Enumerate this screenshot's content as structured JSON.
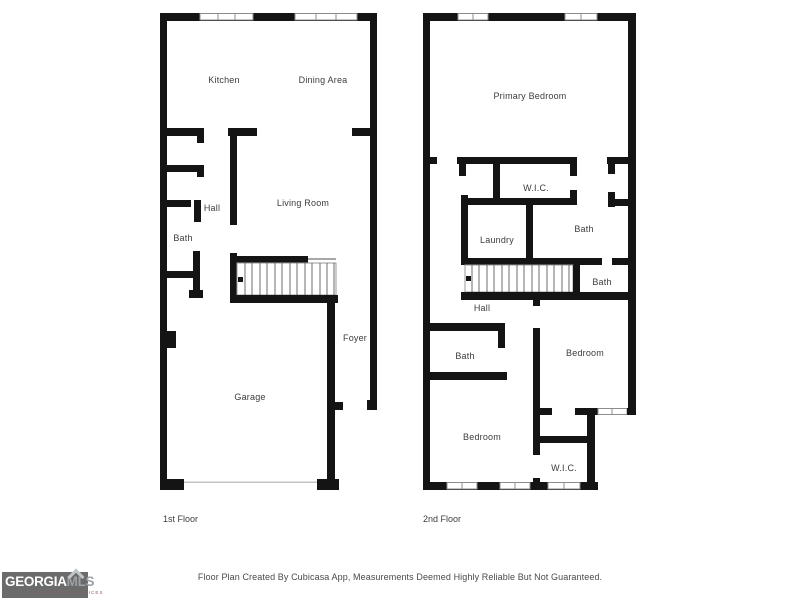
{
  "page": {
    "background": "#ffffff"
  },
  "floors": [
    {
      "title": "1st Floor",
      "rooms": [
        {
          "label": "Kitchen"
        },
        {
          "label": "Dining Area"
        },
        {
          "label": "Living Room"
        },
        {
          "label": "Hall"
        },
        {
          "label": "Bath"
        },
        {
          "label": "Foyer"
        },
        {
          "label": "Garage"
        }
      ]
    },
    {
      "title": "2nd Floor",
      "rooms": [
        {
          "label": "Primary Bedroom"
        },
        {
          "label": "W.I.C."
        },
        {
          "label": "Laundry"
        },
        {
          "label": "Bath"
        },
        {
          "label": "Bath"
        },
        {
          "label": "Hall"
        },
        {
          "label": "Bath"
        },
        {
          "label": "Bedroom"
        },
        {
          "label": "Bedroom"
        },
        {
          "label": "W.I.C."
        }
      ]
    }
  ],
  "footer": {
    "disclaimer": "Floor Plan Created By Cubicasa App, Measurements Deemed Highly Reliable But Not Guaranteed."
  },
  "logo": {
    "brand": "GEORGIA",
    "suffix": "MLS",
    "tagline": "REAL ESTATE SERVICES"
  },
  "colors": {
    "wall": "#141414",
    "label_text": "#3c3c3c",
    "window_outline": "#8d8d8d",
    "logo_bg": "#6b6b6b",
    "logo_brand": "#ffffff",
    "logo_suffix": "#9ba1a4",
    "logo_tagline": "#8a6060"
  }
}
